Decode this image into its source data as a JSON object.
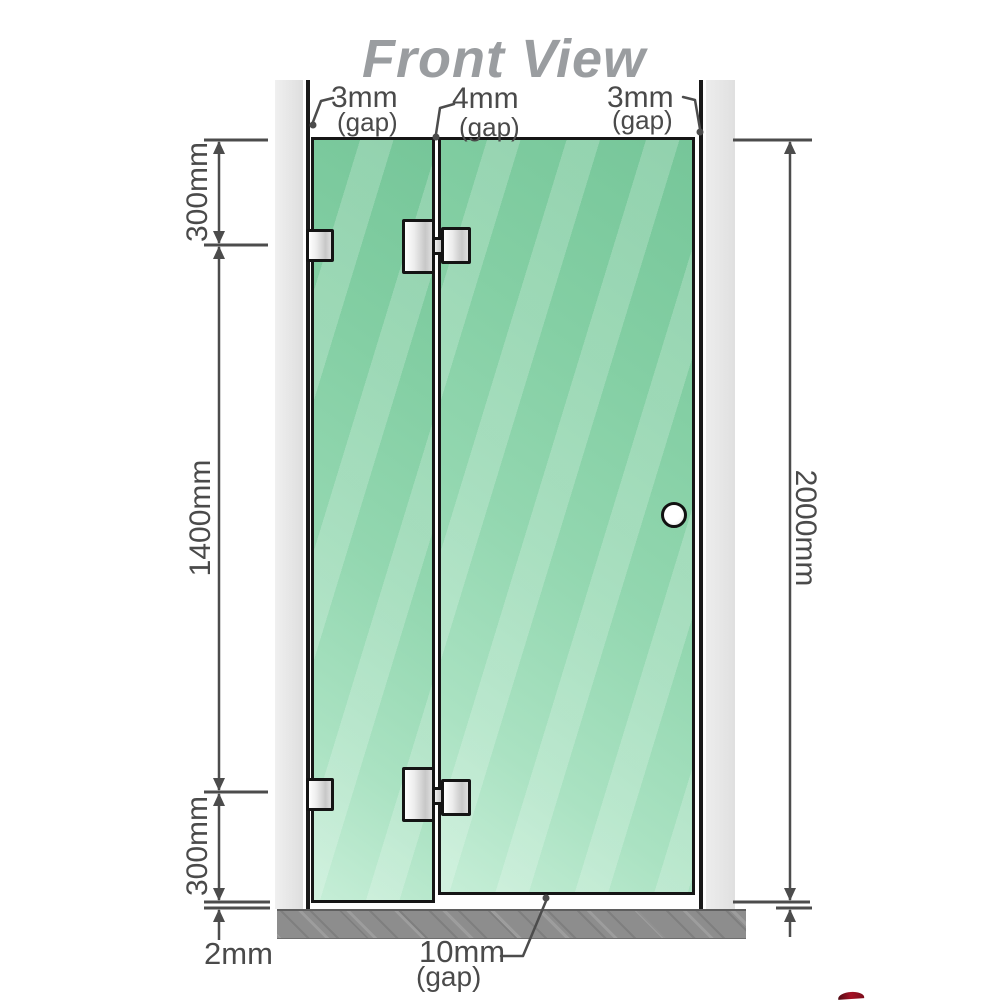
{
  "title": "Front View",
  "gaps": {
    "top_left": {
      "value": "3mm",
      "caption": "(gap)"
    },
    "top_middle": {
      "value": "4mm",
      "caption": "(gap)"
    },
    "top_right": {
      "value": "3mm",
      "caption": "(gap)"
    },
    "bottom_door": {
      "value": "10mm",
      "caption": "(gap)"
    },
    "bottom_panel": {
      "value": "2mm"
    }
  },
  "heights": {
    "segment_top": "300mm",
    "segment_middle": "1400mm",
    "segment_bottom": "300mm",
    "total": "2000mm"
  },
  "diagram": {
    "type": "shower-screen-front-view",
    "panels": [
      {
        "name": "fixed-glass-panel",
        "hardware": [
          "wall-bracket-top",
          "wall-bracket-bottom"
        ]
      },
      {
        "name": "door-glass-panel",
        "hardware": [
          "hinge-top",
          "hinge-bottom",
          "round-handle"
        ]
      }
    ],
    "dimension_values_mm": {
      "top_gap_left": 3,
      "top_gap_middle": 4,
      "top_gap_right": 3,
      "bracket_offset_top": 300,
      "bracket_spacing": 1400,
      "bracket_offset_bottom": 300,
      "glass_height": 2000,
      "floor_gap_panel": 2,
      "floor_gap_door": 10
    }
  },
  "colors": {
    "glass_green": "#84cfa4",
    "glass_green_light": "#c6eed7",
    "frame_black": "#161616",
    "wall_channel_gray": "#e6e6e6",
    "floor_gray": "#8d8d8d",
    "dimension_gray": "#4a4a4a",
    "title_gray": "#9a9da0",
    "hardware_metal": "#e0e0e0",
    "watermark_red": "#a51226"
  }
}
